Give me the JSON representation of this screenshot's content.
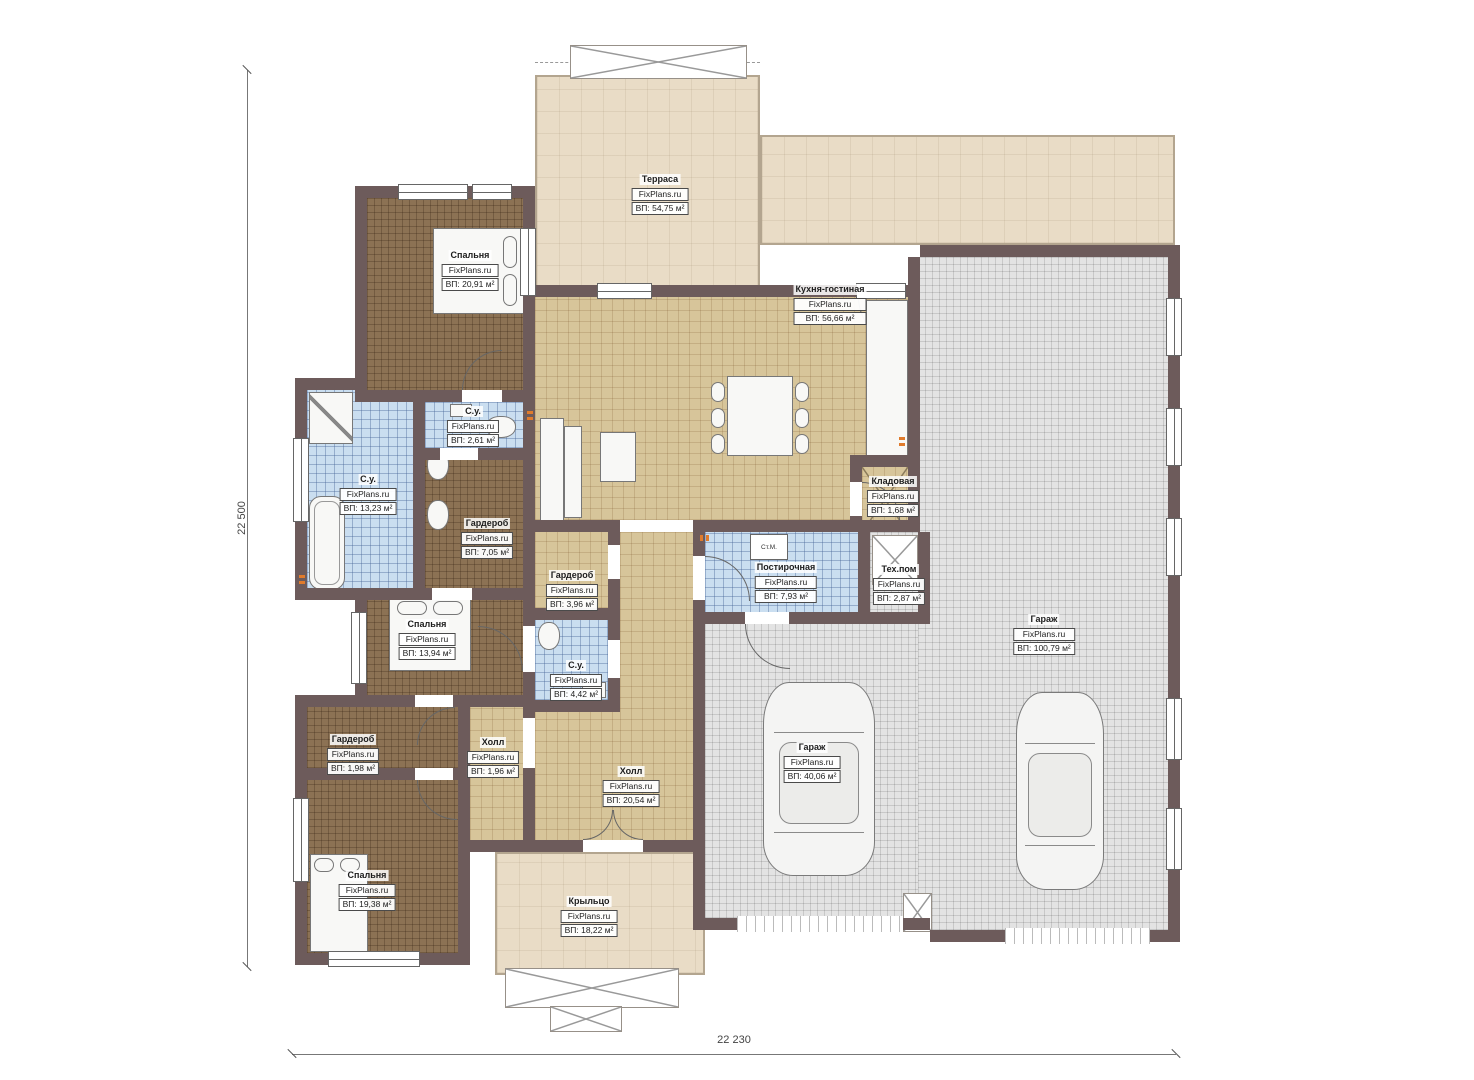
{
  "brand": "FixPlans.ru",
  "dimensions": {
    "left": "22 500",
    "bottom": "22 230"
  },
  "annotations": {
    "washing_machine": "Ст.М."
  },
  "rooms": [
    {
      "name": "Терраса",
      "area": "ВП: 54,75 м²"
    },
    {
      "name": "Спальня",
      "area": "ВП: 20,91 м²"
    },
    {
      "name": "Кухня-гостиная",
      "area": "ВП: 56,66 м²"
    },
    {
      "name": "С.у.",
      "area": "ВП: 2,61 м²"
    },
    {
      "name": "С.у.",
      "area": "ВП: 13,23 м²"
    },
    {
      "name": "Гардероб",
      "area": "ВП: 7,05 м²"
    },
    {
      "name": "Гардероб",
      "area": "ВП: 3,96 м²"
    },
    {
      "name": "Кладовая",
      "area": "ВП: 1,68 м²"
    },
    {
      "name": "Постирочная",
      "area": "ВП: 7,93 м²"
    },
    {
      "name": "Тех.пом",
      "area": "ВП: 2,87 м²"
    },
    {
      "name": "Гараж",
      "area": "ВП: 100,79 м²"
    },
    {
      "name": "Гараж",
      "area": "ВП: 40,06 м²"
    },
    {
      "name": "Спальня",
      "area": "ВП: 13,94 м²"
    },
    {
      "name": "С.у.",
      "area": "ВП: 4,42 м²"
    },
    {
      "name": "Холл",
      "area": "ВП: 1,96 м²"
    },
    {
      "name": "Холл",
      "area": "ВП: 20,54 м²"
    },
    {
      "name": "Гардероб",
      "area": "ВП: 1,98 м²"
    },
    {
      "name": "Спальня",
      "area": "ВП: 19,38 м²"
    },
    {
      "name": "Крыльцо",
      "area": "ВП: 18,22 м²"
    }
  ],
  "colors": {
    "wall": "#6d5b5b",
    "terrace": "#e9dcc6",
    "wood_floor": "#8c7254",
    "tile_tan": "#d7c59a",
    "tile_blue": "#cadef0",
    "garage": "#e3e3e3",
    "radiator": "#e07b2c"
  }
}
